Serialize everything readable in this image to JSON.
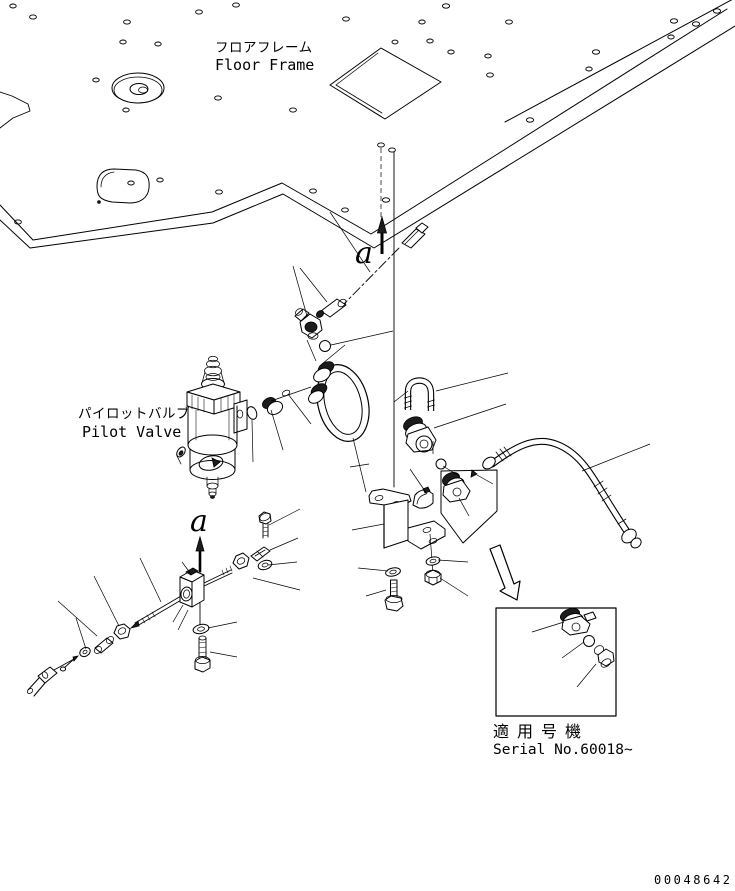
{
  "labels": {
    "floor_frame_jp": "フロアフレーム",
    "floor_frame_en": "Floor Frame",
    "pilot_valve_jp": "パイロットバルブ",
    "pilot_valve_en": "Pilot Valve",
    "applicable_model_jp": "適用号機",
    "applicable_model_en": "Serial No.60018~",
    "detail_marker_a_top": "a",
    "detail_marker_a_bottom": "a",
    "drawing_number": "00048642"
  },
  "colors": {
    "line": "#000000",
    "background": "#ffffff",
    "dark_fill": "#1c1c1c"
  }
}
